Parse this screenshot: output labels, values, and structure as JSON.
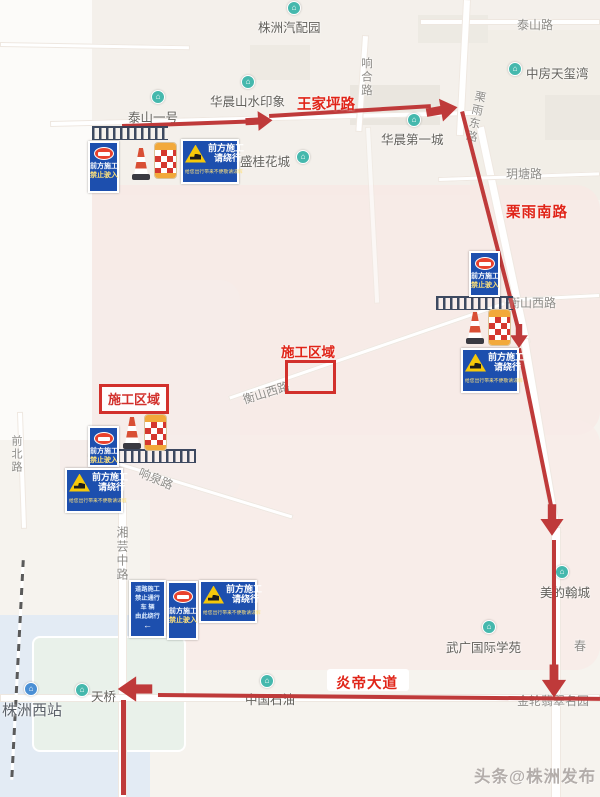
{
  "labels": {
    "zhuzhou_auto_park": "株洲汽配园",
    "taishan_road": "泰山路",
    "zhongfang_tianxiwan": "中房天玺湾",
    "huachen_shanshui_yinxiang": "华晨山水印象",
    "taishan_yihao": "泰山一号",
    "xianghe_road": "响合路",
    "huachen_diyicheng": "华晨第一城",
    "sheng_guihuacheng": "盛桂花城",
    "liyu_east_road": "栗雨东路",
    "yuetang_road": "玥塘路",
    "hengshan_west_road": "衡山西路",
    "xiangquan_road": "响泉路",
    "qianbei_road": "前北路",
    "xiangyun_middle_road": "湘芸中路",
    "zhuzhou_west_station": "株洲西站",
    "tianqiao": "天桥",
    "china_petroleum": "中国石油",
    "meidi_hancheng": "美的翰城",
    "wuguang_international": "武广国际学苑",
    "chun": "春",
    "jinlun_feicui_mingyuan": "金轮翡翠名园"
  },
  "red_labels": {
    "wangjiaping_road": "王家坪路",
    "liyu_south_road": "栗雨南路",
    "yandi_avenue": "炎帝大道",
    "construction_zone": "施工区域"
  },
  "signs": {
    "no_entry": {
      "line1": "前方施工",
      "line2": "禁止驶入"
    },
    "detour": {
      "line1": "前方施工",
      "line2": "请绕行",
      "note": "给您出行带来不便敬请谅解"
    },
    "detour_direction": {
      "line1": "道路施工",
      "line2": "禁止通行",
      "line3": "车 辆",
      "line4": "由此绕行",
      "arrow": "←"
    }
  },
  "watermark": "头条@株洲发布",
  "icons": {
    "poi_glyph": "⌂"
  },
  "colors": {
    "route": "#bf3a3a",
    "redlabel": "#e02418",
    "zonebox": "#d2302c",
    "signblue": "#1d4fae",
    "poiteal": "#45b8ad",
    "poiblue": "#4a8fd4",
    "conered": "#d94f35",
    "barrelyellow": "#f2a93b"
  }
}
